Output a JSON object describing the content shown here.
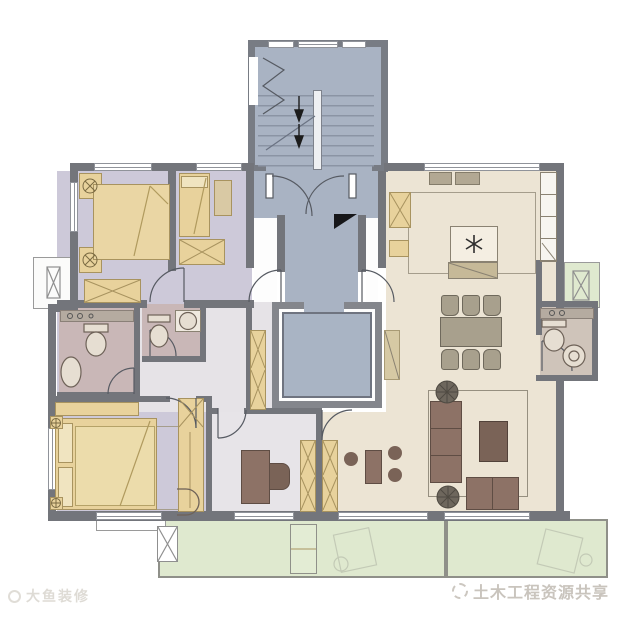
{
  "image_type": "residential apartment floor plan drawing",
  "watermarks": {
    "left": {
      "icon": "smiley-logo",
      "text": "大鱼装修"
    },
    "right": {
      "icon": "circle-badge-logo",
      "text": "土木工程资源共享"
    }
  },
  "palette": {
    "wall": "#73757b",
    "stair_core_blue": "#a9b3c3",
    "elevator_blue": "#a9b4c4",
    "bedroom_lavender": "#cdc9d9",
    "bathroom_mauve": "#c9b7b7",
    "living_cream": "#ece4d4",
    "hall_white": "#e6e3e7",
    "balcony_green": "#dfe9cf",
    "furniture_tan": "#e8d29c",
    "sofa_brown": "#8d7266",
    "chair_gray": "#a8a08d"
  },
  "legend": {
    "zones": [
      "staircase-core",
      "entry-lobby",
      "elevator-shaft",
      "bedroom-1",
      "bedroom-2",
      "master-bedroom",
      "study",
      "bathroom-1",
      "bathroom-2",
      "bathroom-3",
      "kitchen",
      "dining-room",
      "living-room",
      "hallway",
      "balcony-left",
      "balcony-right",
      "ac-platform-left",
      "ac-platform-right"
    ],
    "symbols": [
      "stair-direction-arrow",
      "door-swing-arc",
      "double-door-arc",
      "north-triangle-marker",
      "cooktop-asterisk",
      "wardrobe-x",
      "toilet",
      "sink",
      "bathtub-oval",
      "double-bed",
      "single-bed",
      "dining-table-six-chairs",
      "l-shaped-sofa",
      "coffee-table",
      "potted-plant",
      "desk-and-chair",
      "washing-machine-sketch"
    ]
  }
}
